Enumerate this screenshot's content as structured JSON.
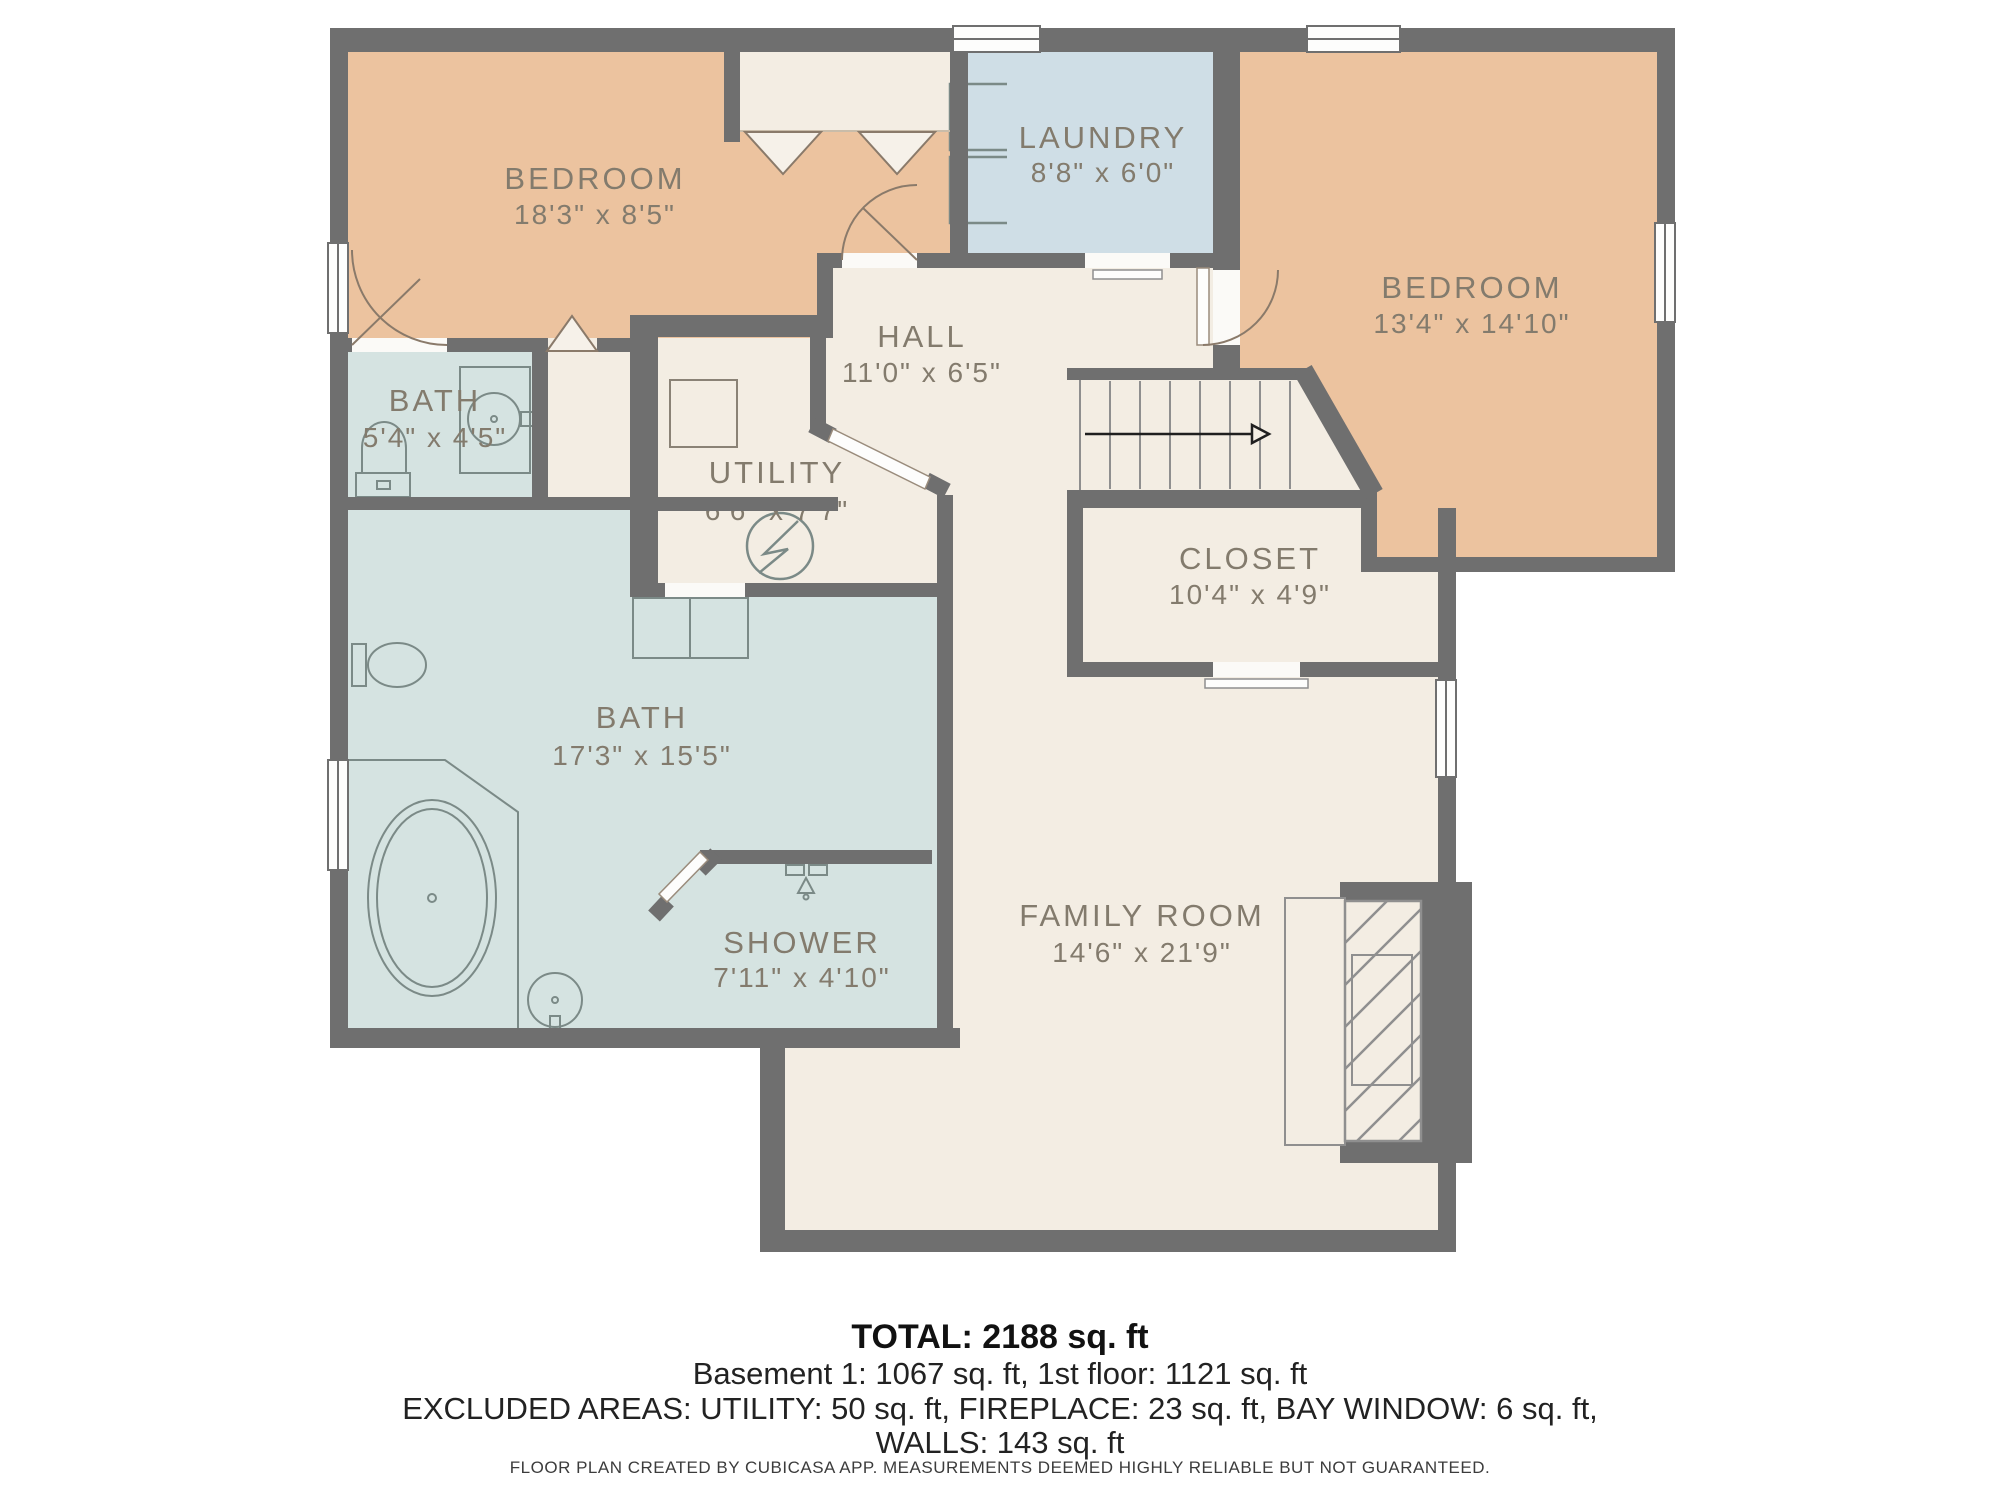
{
  "title": "Floor plan",
  "colors": {
    "wall": "#6f6f6f",
    "bedroom_fill": "#ecc39f",
    "laundry_fill": "#cfdee6",
    "bath_fill": "#d5e3e1",
    "hall_fill": "#f3ede3",
    "label_text": "#837b6d",
    "summary_text": "#111111"
  },
  "rooms": [
    {
      "id": "bedroom-1",
      "name": "BEDROOM",
      "dims": "18'3\" x 8'5\""
    },
    {
      "id": "laundry",
      "name": "LAUNDRY",
      "dims": "8'8\" x 6'0\""
    },
    {
      "id": "bedroom-2",
      "name": "BEDROOM",
      "dims": "13'4\" x 14'10\""
    },
    {
      "id": "bath-small",
      "name": "BATH",
      "dims": "5'4\" x 4'5\""
    },
    {
      "id": "hall",
      "name": "HALL",
      "dims": "11'0\" x 6'5\""
    },
    {
      "id": "utility",
      "name": "UTILITY",
      "dims": "6'6\" x 7'7\""
    },
    {
      "id": "closet",
      "name": "CLOSET",
      "dims": "10'4\" x 4'9\""
    },
    {
      "id": "bath-large",
      "name": "BATH",
      "dims": "17'3\" x 15'5\""
    },
    {
      "id": "shower",
      "name": "SHOWER",
      "dims": "7'11\" x 4'10\""
    },
    {
      "id": "family-room",
      "name": "FAMILY ROOM",
      "dims": "14'6\" x 21'9\""
    }
  ],
  "icons": [
    "washer-icon",
    "dryer-icon",
    "toilet-icon",
    "sink-icon",
    "bathtub-icon",
    "shower-head-icon",
    "electrical-panel-icon",
    "furnace-icon",
    "stairs-arrow-icon",
    "fireplace-icon",
    "window-icon",
    "door-swing-icon",
    "bifold-door-icon"
  ],
  "summary": {
    "total": "TOTAL: 2188 sq. ft",
    "floors": "Basement 1: 1067 sq. ft, 1st floor: 1121 sq. ft",
    "excluded1": "EXCLUDED AREAS: UTILITY: 50 sq. ft, FIREPLACE: 23 sq. ft, BAY WINDOW: 6 sq. ft,",
    "excluded2": "WALLS: 143 sq. ft",
    "disclaimer": "FLOOR PLAN CREATED BY CUBICASA APP. MEASUREMENTS DEEMED HIGHLY RELIABLE BUT NOT GUARANTEED."
  }
}
